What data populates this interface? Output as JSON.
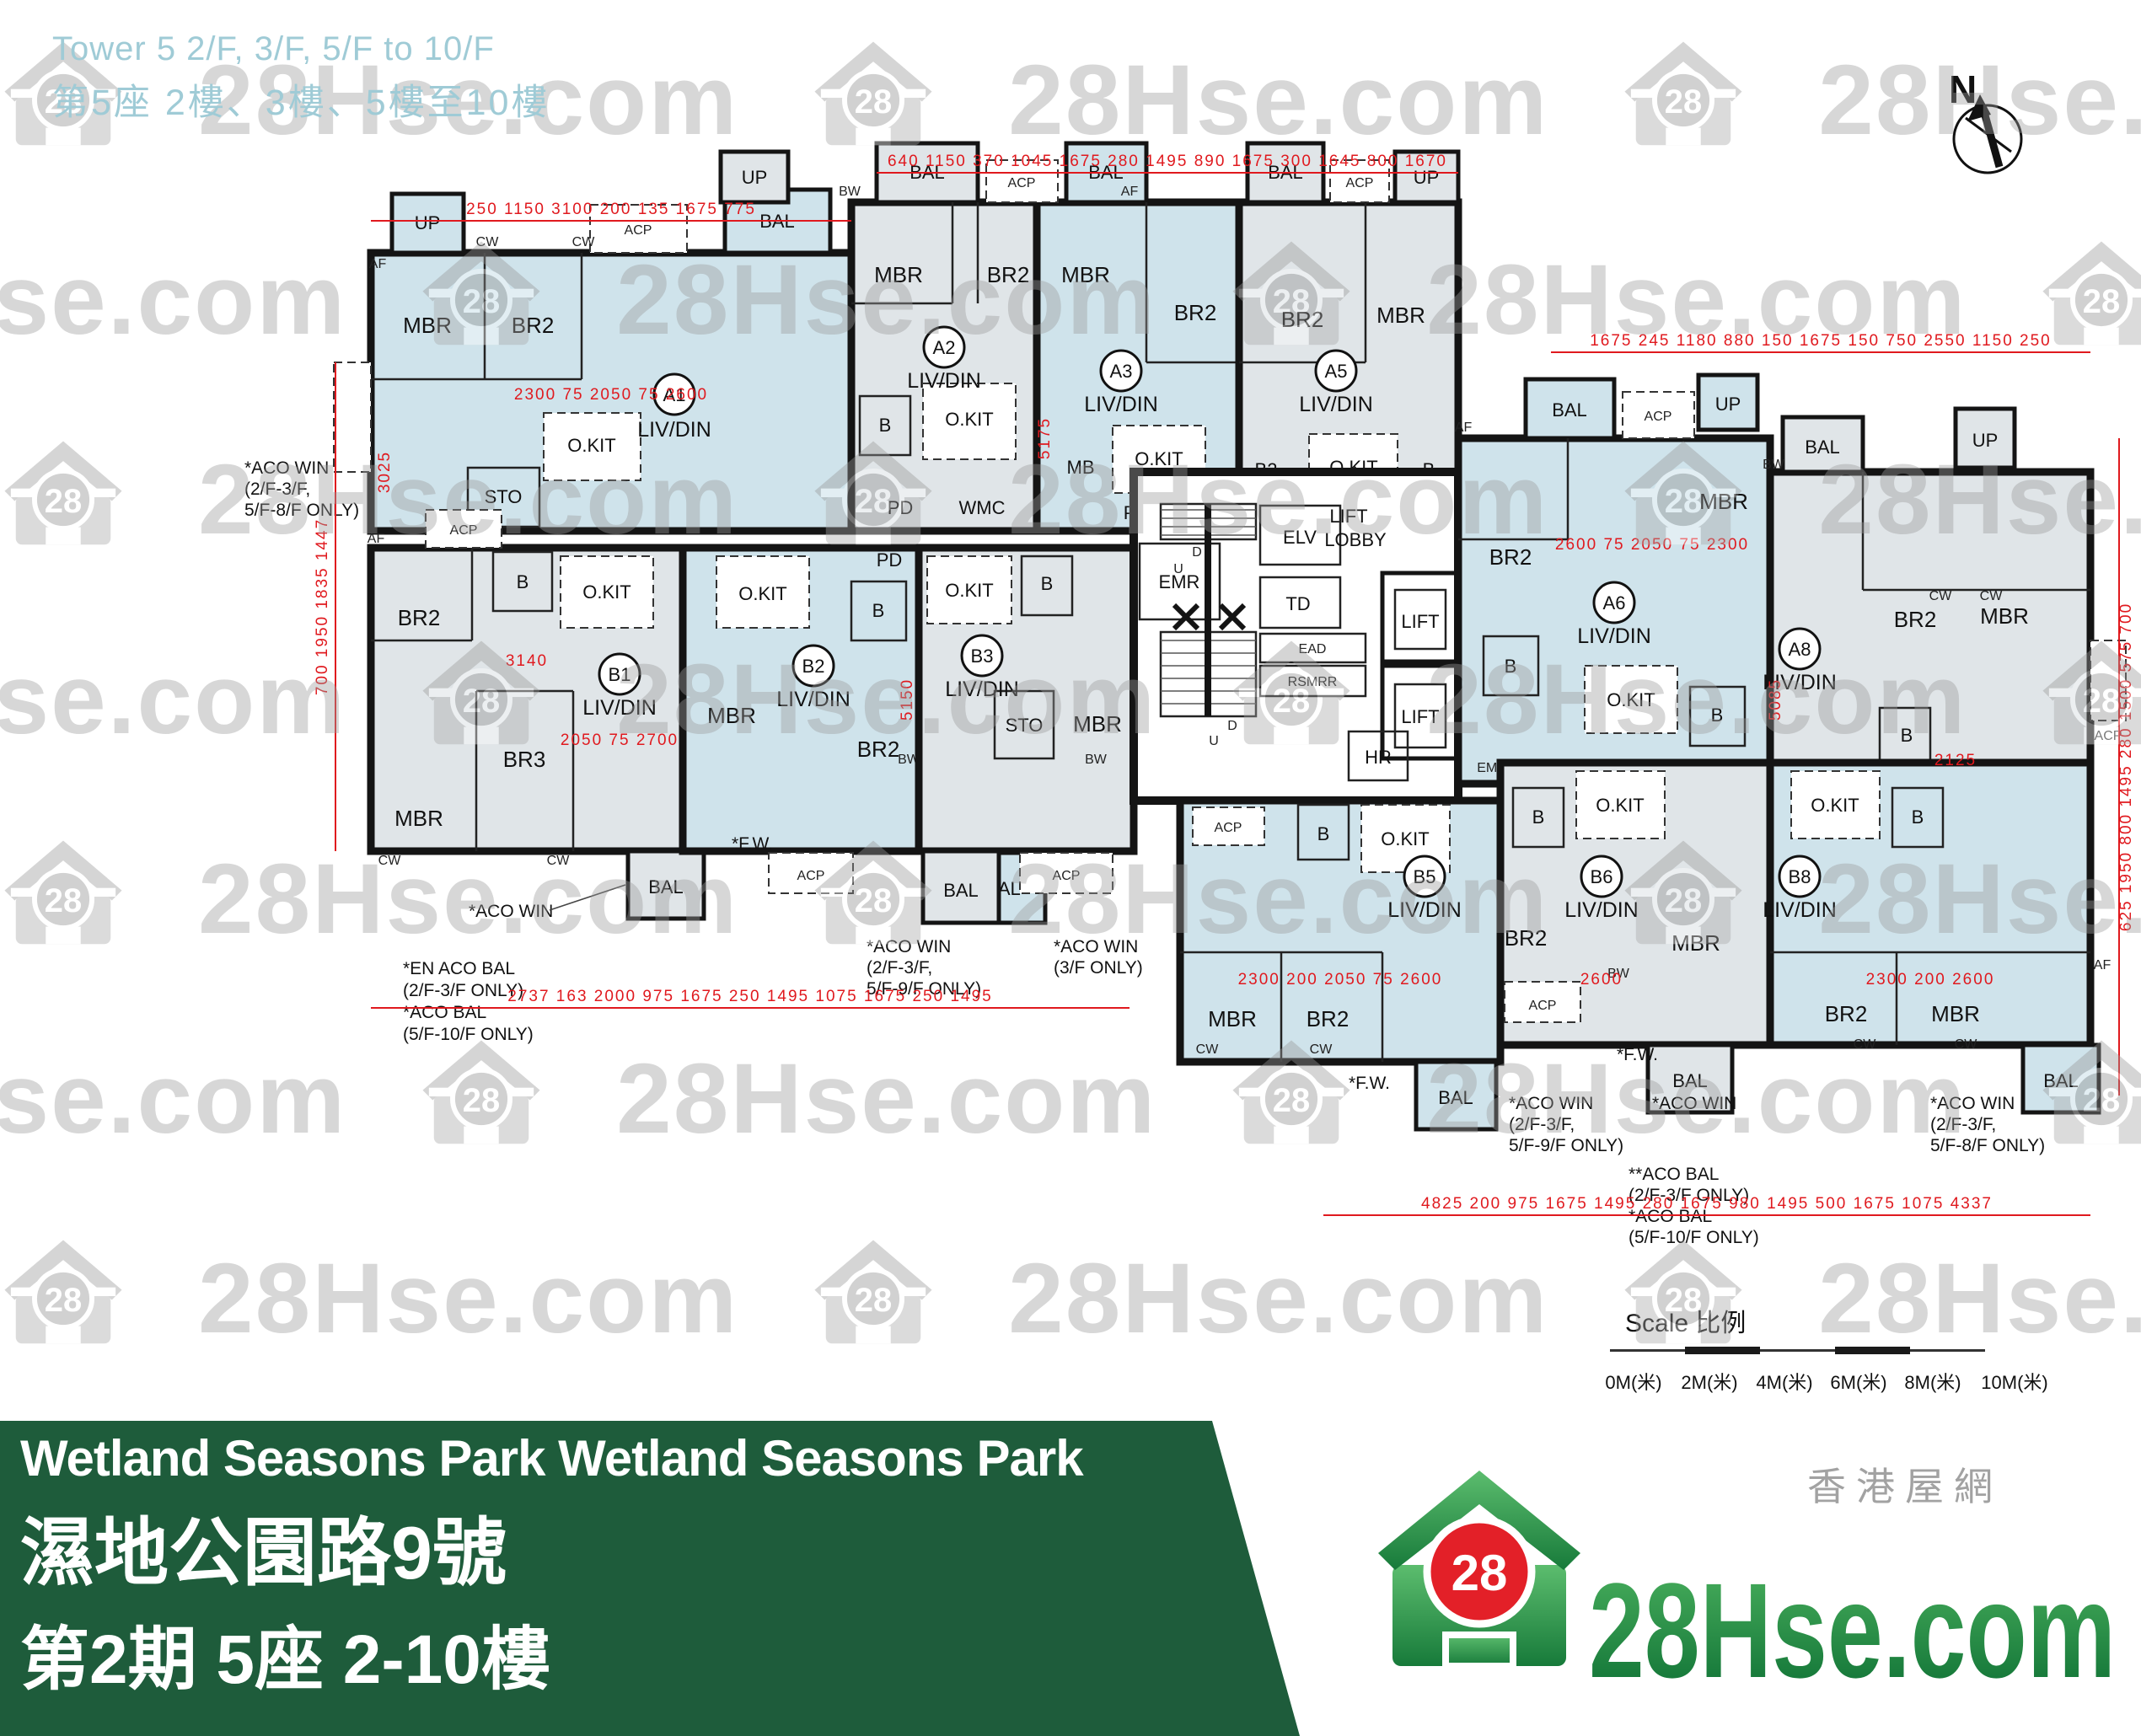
{
  "header": {
    "line1": "Tower 5 2/F, 3/F, 5/F to 10/F",
    "line2": "第5座 2樓、3樓、5樓至10樓"
  },
  "compass": {
    "label": "N"
  },
  "watermark": {
    "text": "28Hse.com",
    "badge": "28"
  },
  "units": [
    {
      "id": "A1",
      "label": "LIV/DIN",
      "rooms": [
        "MBR",
        "BR2",
        "O.KIT",
        "STO",
        "BAL",
        "UP",
        "ACP"
      ]
    },
    {
      "id": "A2",
      "label": "LIV/DIN",
      "rooms": [
        "MBR",
        "BR2",
        "B",
        "O.KIT",
        "PD",
        "WMC",
        "BAL",
        "UP"
      ]
    },
    {
      "id": "A3",
      "label": "LIV/DIN",
      "rooms": [
        "MBR",
        "BR2",
        "MB",
        "O.KIT",
        "PD",
        "BAL"
      ]
    },
    {
      "id": "A5",
      "label": "LIV/DIN",
      "rooms": [
        "MBR",
        "BR2",
        "B2",
        "B",
        "O.KIT",
        "PD",
        "HR",
        "BAL",
        "UP"
      ]
    },
    {
      "id": "A6",
      "label": "LIV/DIN",
      "rooms": [
        "MBR",
        "BR2",
        "B",
        "O.KIT",
        "PD",
        "EMR",
        "BAL",
        "UP",
        "ACP"
      ]
    },
    {
      "id": "A8",
      "label": "LIV/DIN",
      "rooms": [
        "MBR",
        "BR2",
        "B",
        "O.KIT",
        "STO",
        "BAL",
        "UP",
        "ACP"
      ]
    },
    {
      "id": "B1",
      "label": "LIV/DIN",
      "rooms": [
        "MBR",
        "BR2",
        "BR3",
        "B",
        "O.KIT",
        "BAL",
        "ACP"
      ]
    },
    {
      "id": "B2",
      "label": "LIV/DIN",
      "rooms": [
        "MBR",
        "BR2",
        "B",
        "O.KIT",
        "PD",
        "BAL",
        "ACP"
      ]
    },
    {
      "id": "B3",
      "label": "LIV/DIN",
      "rooms": [
        "MBR",
        "STO",
        "B",
        "O.KIT",
        "BAL",
        "ACP"
      ]
    },
    {
      "id": "B5",
      "label": "LIV/DIN",
      "rooms": [
        "MBR",
        "BR2",
        "B",
        "O.KIT",
        "BAL",
        "ACP"
      ]
    },
    {
      "id": "B6",
      "label": "LIV/DIN",
      "rooms": [
        "MBR",
        "BR2",
        "B",
        "O.KIT",
        "BAL",
        "ACP"
      ]
    },
    {
      "id": "B8",
      "label": "LIV/DIN",
      "rooms": [
        "MBR",
        "BR2",
        "B",
        "O.KIT",
        "BAL"
      ]
    }
  ],
  "rm": {
    "liv": "LIV/DIN",
    "mbr": "MBR",
    "br2": "BR2",
    "br3": "BR3",
    "mb": "MB",
    "b2": "B2",
    "b": "B",
    "okit": "O.KIT",
    "sto": "STO",
    "bal": "BAL",
    "up": "UP",
    "acp": "ACP",
    "pd": "PD",
    "wmc": "WMC",
    "cw": "CW",
    "bw": "BW",
    "af": "AF"
  },
  "core": {
    "lobby1": "LIFT",
    "lobby2": "LOBBY",
    "lift": "LIFT",
    "elv": "ELV",
    "td": "TD",
    "ead": "EAD",
    "rsmrr": "RSMRR",
    "emr": "EMR",
    "hr": "HR",
    "u": "U",
    "d": "D"
  },
  "notes": {
    "aco_win": "*ACO WIN",
    "en_aco_bal": "*EN ACO BAL",
    "only23": "(2/F-3/F ONLY)",
    "aco_bal": "*ACO BAL",
    "only510": "(5/F-10/F ONLY)",
    "aco_bal2": "**ACO BAL",
    "br23": "(2/F-3/F,",
    "only59": "5/F-9/F ONLY)",
    "only3": "(3/F ONLY)",
    "only58": "5/F-8/F ONLY)",
    "fw": "*F.W."
  },
  "dims": {
    "top_left": "250 1150 3100 200 135 1675 775",
    "top": "640 1150 370 1045 1675 280 1495 890 1675 300 1645 800 1670",
    "right_top": "1675 245 1180 880 150 1675 150 750 2550 1150 250",
    "left": "700 1950 1835 1447",
    "right": "625 1950 800 1495 280 1500 575 700",
    "bottom_left": "2737 163 2000 975 1675 250 1495 1075 1675 250 1495",
    "bottom_right": "4825 200 975 1675 1495 280 1675 980 1495 500 1675 1075 4337",
    "inner": [
      "2300 75 2050 75 2600",
      "5175",
      "3025",
      "3140",
      "2050 75 2700",
      "5150",
      "2600 75 2050 75 2300",
      "5085",
      "2125",
      "2300 200 2050 75 2600",
      "2300 200 2600",
      "2600"
    ]
  },
  "scalebar": {
    "title": "Scale 比例",
    "labels": [
      "0M(米)",
      "2M(米)",
      "4M(米)",
      "6M(米)",
      "8M(米)",
      "10M(米)"
    ]
  },
  "footer": {
    "line1": "Wetland Seasons Park Wetland Seasons Park",
    "line2": "濕地公園路9號",
    "line3": "第2期 5座 2-10樓",
    "brand_zh": "香港屋網",
    "brand": "28Hse.com",
    "badge": "28"
  }
}
